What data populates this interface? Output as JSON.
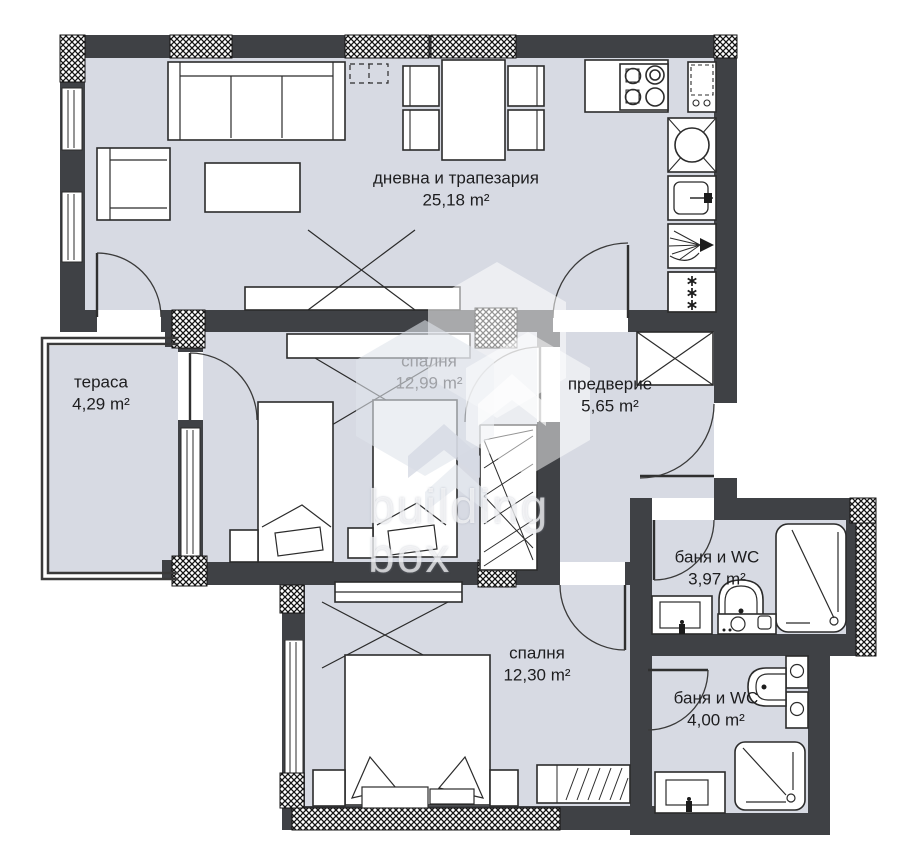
{
  "watermark": {
    "line1": "building",
    "line2": "box"
  },
  "rooms": [
    {
      "name": "дневна и трапезария",
      "area": "25,18 m²"
    },
    {
      "name": "тераса",
      "area": "4,29 m²"
    },
    {
      "name": "спалня",
      "area": "12,99 m²"
    },
    {
      "name": "предверие",
      "area": "5,65 m²"
    },
    {
      "name": "баня и WC",
      "area": "3,97 m²"
    },
    {
      "name": "спалня",
      "area": "12,30 m²"
    },
    {
      "name": "баня и WC",
      "area": "4,00 m²"
    }
  ],
  "colors": {
    "floor": "#d7dae3",
    "wall": "#3f4145",
    "line": "#2b2b2b",
    "label": "#1d1d1f",
    "label_muted": "#9fa1a6",
    "watermark": "rgba(255,255,255,0.66)"
  }
}
